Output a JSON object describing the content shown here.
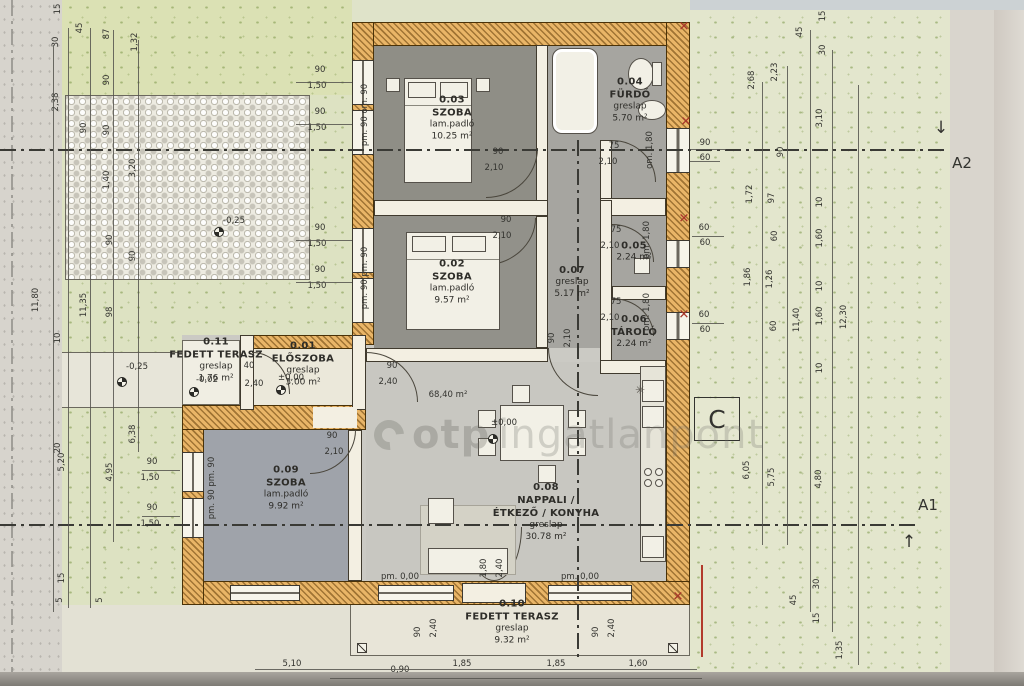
{
  "watermark": {
    "bold": "otp",
    "light": "ingatlanpont"
  },
  "sections": {
    "a1": "A1",
    "a2": "A2",
    "c": "C",
    "a1_arrow": "↑",
    "a2_arrow": "↓"
  },
  "symbols": {
    "x_mark": "✕",
    "plant": "✳"
  },
  "rooms": [
    {
      "number": "0.03",
      "name": "SZOBA",
      "floor": "lam.padló",
      "area": "10.25 m²",
      "x": 452,
      "y": 118
    },
    {
      "number": "0.04",
      "name": "FÜRDŐ",
      "floor": "greslap",
      "area": "5.70 m²",
      "x": 630,
      "y": 100
    },
    {
      "number": "0.02",
      "name": "SZOBA",
      "floor": "lam.padló",
      "area": "9.57 m²",
      "x": 452,
      "y": 282
    },
    {
      "number": "0.07",
      "floor": "greslap",
      "area": "5.17 m²",
      "x": 572,
      "y": 282
    },
    {
      "number": "0.05",
      "area": "2.24 m²",
      "x": 634,
      "y": 252
    },
    {
      "number": "0.06",
      "name": "TÁROLÓ",
      "area": "2.24 m²",
      "x": 634,
      "y": 332
    },
    {
      "number": "0.01",
      "name": "ELŐSZOBA",
      "floor": "greslap",
      "area": "3.00 m²",
      "x": 303,
      "y": 364
    },
    {
      "number": "0.11",
      "name": "FEDETT TERASZ",
      "floor": "greslap",
      "area": "1.76 m²",
      "x": 216,
      "y": 360
    },
    {
      "number": "0.09",
      "name": "SZOBA",
      "floor": "lam.padló",
      "area": "9.92 m²",
      "x": 286,
      "y": 488
    },
    {
      "number": "0.08",
      "name": "NAPPALI /",
      "name2": "ÉTKEZŐ / KONYHA",
      "floor": "greslap",
      "area": "30.78 m²",
      "x": 546,
      "y": 512
    },
    {
      "number": "0.10",
      "name": "FEDETT TERASZ",
      "floor": "greslap",
      "area": "9.32 m²",
      "x": 512,
      "y": 622
    }
  ],
  "levels": [
    {
      "t": "-0,25",
      "x": 234,
      "y": 221,
      "sx": 219,
      "sy": 232
    },
    {
      "t": "-0,25",
      "x": 137,
      "y": 367,
      "sx": 122,
      "sy": 382
    },
    {
      "t": "-0,02",
      "x": 207,
      "y": 380,
      "sx": 194,
      "sy": 392
    },
    {
      "t": "±0,00",
      "x": 291,
      "y": 378,
      "sx": 281,
      "sy": 390
    },
    {
      "t": "±0,00",
      "x": 504,
      "y": 423,
      "sx": 493,
      "sy": 439
    }
  ],
  "dims": [
    {
      "t": "15",
      "x": 58,
      "y": 9,
      "r": 1
    },
    {
      "t": "30",
      "x": 56,
      "y": 42,
      "r": 1
    },
    {
      "t": "45",
      "x": 80,
      "y": 28,
      "r": 1
    },
    {
      "t": "87",
      "x": 107,
      "y": 34,
      "r": 1
    },
    {
      "t": "1,32",
      "x": 135,
      "y": 42,
      "r": 1
    },
    {
      "t": "90",
      "x": 107,
      "y": 80,
      "r": 1
    },
    {
      "t": "2,38",
      "x": 56,
      "y": 102,
      "r": 1
    },
    {
      "t": "90",
      "x": 84,
      "y": 128,
      "r": 1
    },
    {
      "t": "90",
      "x": 107,
      "y": 130,
      "r": 1
    },
    {
      "t": "1,40",
      "x": 107,
      "y": 180,
      "r": 1
    },
    {
      "t": "3,20",
      "x": 133,
      "y": 168,
      "r": 1
    },
    {
      "t": "90",
      "x": 110,
      "y": 240,
      "r": 1
    },
    {
      "t": "90",
      "x": 133,
      "y": 256,
      "r": 1
    },
    {
      "t": "11,80",
      "x": 36,
      "y": 300,
      "r": 1
    },
    {
      "t": "11,35",
      "x": 84,
      "y": 305,
      "r": 1
    },
    {
      "t": "98",
      "x": 110,
      "y": 312,
      "r": 1
    },
    {
      "t": "10",
      "x": 58,
      "y": 338,
      "r": 1
    },
    {
      "t": "20",
      "x": 58,
      "y": 448,
      "r": 1
    },
    {
      "t": "5,20",
      "x": 62,
      "y": 462,
      "r": 1
    },
    {
      "t": "4,95",
      "x": 110,
      "y": 472,
      "r": 1
    },
    {
      "t": "6,38",
      "x": 133,
      "y": 434,
      "r": 1
    },
    {
      "t": "90",
      "x": 152,
      "y": 462
    },
    {
      "t": "1,50",
      "x": 150,
      "y": 478
    },
    {
      "t": "90",
      "x": 152,
      "y": 508
    },
    {
      "t": "1,50",
      "x": 150,
      "y": 524
    },
    {
      "t": "15",
      "x": 62,
      "y": 578,
      "r": 1
    },
    {
      "t": "5",
      "x": 60,
      "y": 600,
      "r": 1
    },
    {
      "t": "5",
      "x": 100,
      "y": 600,
      "r": 1
    },
    {
      "t": "pm. 90  om. 90",
      "x": 365,
      "y": 115,
      "r": 1
    },
    {
      "t": "pm. 90  pm. 90",
      "x": 365,
      "y": 278,
      "r": 1
    },
    {
      "t": "pm. 90  pm. 90",
      "x": 212,
      "y": 488,
      "r": 1
    },
    {
      "t": "90",
      "x": 320,
      "y": 70
    },
    {
      "t": "1,50",
      "x": 317,
      "y": 86
    },
    {
      "t": "90",
      "x": 320,
      "y": 112
    },
    {
      "t": "1,50",
      "x": 317,
      "y": 128
    },
    {
      "t": "90",
      "x": 320,
      "y": 228
    },
    {
      "t": "1,50",
      "x": 317,
      "y": 244
    },
    {
      "t": "90",
      "x": 320,
      "y": 270
    },
    {
      "t": "1,50",
      "x": 317,
      "y": 286
    },
    {
      "t": "90",
      "x": 498,
      "y": 152
    },
    {
      "t": "2,10",
      "x": 494,
      "y": 168
    },
    {
      "t": "75",
      "x": 614,
      "y": 146
    },
    {
      "t": "2,10",
      "x": 608,
      "y": 162
    },
    {
      "t": "90",
      "x": 506,
      "y": 220
    },
    {
      "t": "2,10",
      "x": 502,
      "y": 236
    },
    {
      "t": "75",
      "x": 616,
      "y": 230
    },
    {
      "t": "2,10",
      "x": 610,
      "y": 246
    },
    {
      "t": "75",
      "x": 616,
      "y": 302
    },
    {
      "t": "2,10",
      "x": 610,
      "y": 318
    },
    {
      "t": "90",
      "x": 552,
      "y": 338,
      "r": 1
    },
    {
      "t": "2,10",
      "x": 568,
      "y": 338,
      "r": 1
    },
    {
      "t": "90",
      "x": 332,
      "y": 436
    },
    {
      "t": "2,10",
      "x": 334,
      "y": 452
    },
    {
      "t": "90",
      "x": 392,
      "y": 366
    },
    {
      "t": "2,40",
      "x": 388,
      "y": 382
    },
    {
      "t": "40",
      "x": 249,
      "y": 366
    },
    {
      "t": "2,40",
      "x": 254,
      "y": 384
    },
    {
      "t": "om. 1,80",
      "x": 650,
      "y": 150,
      "r": 1
    },
    {
      "t": "pm. 1,80",
      "x": 647,
      "y": 240,
      "r": 1
    },
    {
      "t": "pm. 1,80",
      "x": 647,
      "y": 312,
      "r": 1
    },
    {
      "t": "68,40 m²",
      "x": 448,
      "y": 395
    },
    {
      "t": "1,80",
      "x": 484,
      "y": 568,
      "r": 1
    },
    {
      "t": "2,40",
      "x": 500,
      "y": 568,
      "r": 1
    },
    {
      "t": "pm. 0,00",
      "x": 400,
      "y": 577
    },
    {
      "t": "pm. 0,00",
      "x": 580,
      "y": 577
    },
    {
      "t": "90",
      "x": 418,
      "y": 632,
      "r": 1
    },
    {
      "t": "2,40",
      "x": 434,
      "y": 628,
      "r": 1
    },
    {
      "t": "90",
      "x": 596,
      "y": 632,
      "r": 1
    },
    {
      "t": "2,40",
      "x": 612,
      "y": 628,
      "r": 1
    },
    {
      "t": "5,10",
      "x": 292,
      "y": 664
    },
    {
      "t": "0,90",
      "x": 400,
      "y": 670
    },
    {
      "t": "1,85",
      "x": 462,
      "y": 664
    },
    {
      "t": "1,85",
      "x": 556,
      "y": 664
    },
    {
      "t": "1,60",
      "x": 638,
      "y": 664
    },
    {
      "t": "15",
      "x": 823,
      "y": 16,
      "r": 1
    },
    {
      "t": "30",
      "x": 823,
      "y": 50,
      "r": 1
    },
    {
      "t": "45",
      "x": 800,
      "y": 32,
      "r": 1
    },
    {
      "t": "2,68",
      "x": 752,
      "y": 80,
      "r": 1
    },
    {
      "t": "2,23",
      "x": 775,
      "y": 72,
      "r": 1
    },
    {
      "t": "3,10",
      "x": 820,
      "y": 118,
      "r": 1
    },
    {
      "t": "90",
      "x": 705,
      "y": 143
    },
    {
      "t": "60",
      "x": 705,
      "y": 158
    },
    {
      "t": "90",
      "x": 781,
      "y": 152,
      "r": 1
    },
    {
      "t": "1,72",
      "x": 750,
      "y": 194,
      "r": 1
    },
    {
      "t": "97",
      "x": 772,
      "y": 198,
      "r": 1
    },
    {
      "t": "10",
      "x": 820,
      "y": 202,
      "r": 1
    },
    {
      "t": "60",
      "x": 704,
      "y": 228
    },
    {
      "t": "60",
      "x": 705,
      "y": 243
    },
    {
      "t": "60",
      "x": 775,
      "y": 236,
      "r": 1
    },
    {
      "t": "1,86",
      "x": 748,
      "y": 277,
      "r": 1
    },
    {
      "t": "1,26",
      "x": 770,
      "y": 279,
      "r": 1
    },
    {
      "t": "1,60",
      "x": 820,
      "y": 238,
      "r": 1
    },
    {
      "t": "10",
      "x": 820,
      "y": 286,
      "r": 1
    },
    {
      "t": "60",
      "x": 704,
      "y": 315
    },
    {
      "t": "60",
      "x": 705,
      "y": 330
    },
    {
      "t": "60",
      "x": 774,
      "y": 326,
      "r": 1
    },
    {
      "t": "11,40",
      "x": 797,
      "y": 320,
      "r": 1
    },
    {
      "t": "1,60",
      "x": 820,
      "y": 316,
      "r": 1
    },
    {
      "t": "12,30",
      "x": 844,
      "y": 317,
      "r": 1
    },
    {
      "t": "10",
      "x": 820,
      "y": 368,
      "r": 1
    },
    {
      "t": "6,05",
      "x": 747,
      "y": 470,
      "r": 1
    },
    {
      "t": "5,75",
      "x": 772,
      "y": 477,
      "r": 1
    },
    {
      "t": "4,80",
      "x": 819,
      "y": 479,
      "r": 1
    },
    {
      "t": "45",
      "x": 794,
      "y": 600,
      "r": 1
    },
    {
      "t": "30",
      "x": 817,
      "y": 584,
      "r": 1
    },
    {
      "t": "15",
      "x": 817,
      "y": 618,
      "r": 1
    },
    {
      "t": "1,35",
      "x": 840,
      "y": 650,
      "r": 1
    }
  ],
  "red_marks": [
    {
      "x": 684,
      "y": 27
    },
    {
      "x": 686,
      "y": 122
    },
    {
      "x": 684,
      "y": 219
    },
    {
      "x": 684,
      "y": 315
    },
    {
      "x": 678,
      "y": 597
    }
  ],
  "rules": [
    {
      "x": 53,
      "y": 45,
      "h": 567
    },
    {
      "x": 68,
      "y": 28,
      "h": 580
    },
    {
      "x": 90,
      "y": 28,
      "h": 580
    },
    {
      "x": 113,
      "y": 30,
      "h": 512
    },
    {
      "x": 138,
      "y": 40,
      "h": 412
    },
    {
      "x": 762,
      "y": 82,
      "h": 463
    },
    {
      "x": 787,
      "y": 66,
      "h": 479
    },
    {
      "x": 810,
      "y": 30,
      "h": 582
    },
    {
      "x": 832,
      "y": 50,
      "h": 582
    },
    {
      "x": 858,
      "y": 85,
      "h": 580
    },
    {
      "x": 255,
      "y": 669,
      "w": 442
    },
    {
      "x": 330,
      "y": 678,
      "w": 372
    },
    {
      "x": 690,
      "y": 149,
      "w": 36
    },
    {
      "x": 690,
      "y": 161,
      "w": 30
    },
    {
      "x": 692,
      "y": 236,
      "w": 32
    },
    {
      "x": 692,
      "y": 323,
      "w": 32
    },
    {
      "x": 142,
      "y": 470,
      "w": 38
    },
    {
      "x": 142,
      "y": 516,
      "w": 38
    },
    {
      "x": 296,
      "y": 82,
      "w": 56
    },
    {
      "x": 296,
      "y": 124,
      "w": 56
    },
    {
      "x": 296,
      "y": 240,
      "w": 56
    },
    {
      "x": 296,
      "y": 282,
      "w": 56
    }
  ]
}
